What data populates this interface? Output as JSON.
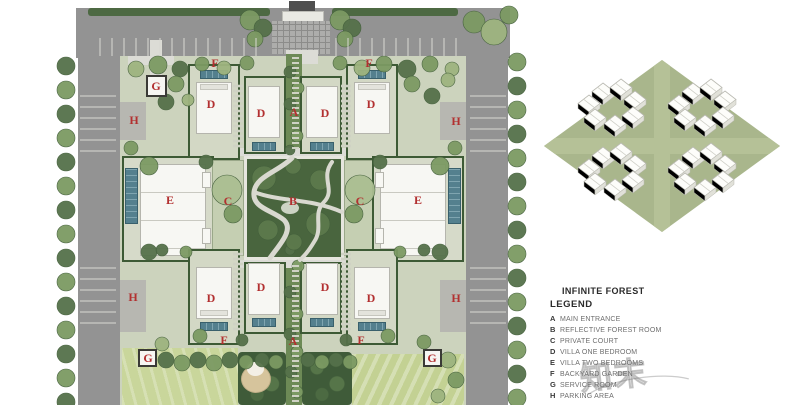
{
  "legend": {
    "title_line1": "INFINITE FOREST",
    "title_line2": "LEGEND",
    "items": [
      {
        "key": "A",
        "label": "MAIN ENTRANCE"
      },
      {
        "key": "B",
        "label": "REFLECTIVE FOREST ROOM"
      },
      {
        "key": "C",
        "label": "PRIVATE COURT"
      },
      {
        "key": "D",
        "label": "VILLA ONE BEDROOM"
      },
      {
        "key": "E",
        "label": "VILLA TWO BEDROOMS"
      },
      {
        "key": "F",
        "label": "BACKYARD GARDEN"
      },
      {
        "key": "G",
        "label": "SERVICE ROOM"
      },
      {
        "key": "H",
        "label": "PARKING AREA"
      }
    ]
  },
  "plan": {
    "markers": [
      {
        "t": "F",
        "x": 215,
        "y": 63
      },
      {
        "t": "F",
        "x": 369,
        "y": 63
      },
      {
        "t": "G",
        "x": 156,
        "y": 86
      },
      {
        "t": "H",
        "x": 134,
        "y": 120
      },
      {
        "t": "H",
        "x": 456,
        "y": 121
      },
      {
        "t": "A",
        "x": 294,
        "y": 112
      },
      {
        "t": "D",
        "x": 211,
        "y": 104
      },
      {
        "t": "D",
        "x": 261,
        "y": 113
      },
      {
        "t": "D",
        "x": 325,
        "y": 113
      },
      {
        "t": "D",
        "x": 371,
        "y": 104
      },
      {
        "t": "E",
        "x": 170,
        "y": 200
      },
      {
        "t": "C",
        "x": 228,
        "y": 201
      },
      {
        "t": "B",
        "x": 293,
        "y": 201
      },
      {
        "t": "C",
        "x": 360,
        "y": 201
      },
      {
        "t": "E",
        "x": 418,
        "y": 200
      },
      {
        "t": "H",
        "x": 133,
        "y": 297
      },
      {
        "t": "H",
        "x": 456,
        "y": 298
      },
      {
        "t": "D",
        "x": 211,
        "y": 298
      },
      {
        "t": "D",
        "x": 261,
        "y": 287
      },
      {
        "t": "D",
        "x": 325,
        "y": 287
      },
      {
        "t": "D",
        "x": 371,
        "y": 298
      },
      {
        "t": "F",
        "x": 224,
        "y": 340
      },
      {
        "t": "A",
        "x": 293,
        "y": 341
      },
      {
        "t": "F",
        "x": 361,
        "y": 340
      },
      {
        "t": "G",
        "x": 148,
        "y": 358
      },
      {
        "t": "G",
        "x": 432,
        "y": 358
      }
    ]
  },
  "watermark": {
    "text": "知末"
  },
  "colors": {
    "marker_red": "#b23030",
    "road_grey": "#939393",
    "block_green": "#ccd3bd",
    "forest_dark": "#49653e",
    "pool_teal": "#54808e",
    "lawn_green": "#c9d69b",
    "axon_green": "#a9b68c"
  }
}
